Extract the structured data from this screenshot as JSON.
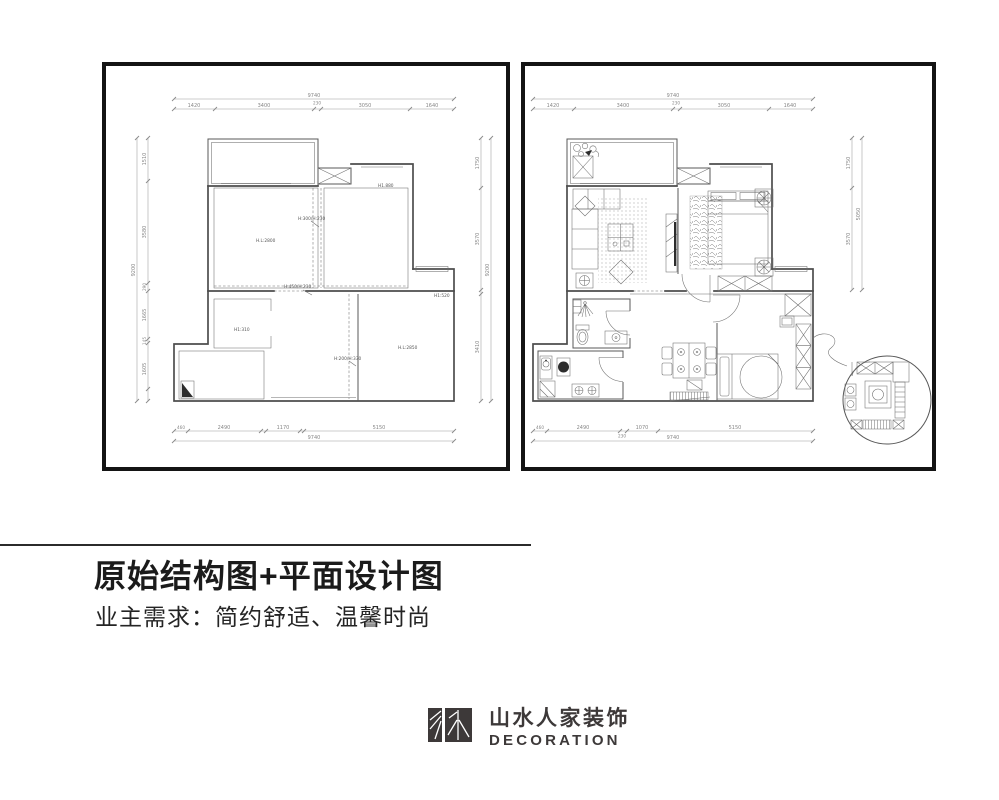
{
  "title_block": {
    "title": "原始结构图+平面设计图",
    "subtitle": "业主需求：简约舒适、温馨时尚"
  },
  "logo": {
    "cn": "山水人家装饰",
    "en": "DECORATION"
  },
  "colors": {
    "panel_border": "#141414",
    "line": "#4d4d4d",
    "dim_text": "#878787",
    "logo": "#3d3939"
  },
  "panels": {
    "left": {
      "dims_top": {
        "overall": "9740",
        "segments": [
          "1420",
          "3400",
          "230",
          "3050",
          "1640"
        ]
      },
      "dims_left": {
        "overall": "9200",
        "segments": [
          "1510",
          "3580",
          "290",
          "1665",
          "145",
          "1605"
        ]
      },
      "dims_right": {
        "overall": "9200",
        "segments": [
          "1750",
          "3570",
          "3410"
        ]
      },
      "dims_bottom": {
        "overall": "9740",
        "segments": [
          "460",
          "2490",
          "1170",
          "5150"
        ]
      },
      "labels": {
        "h1880": "H1.880",
        "hl2800": "H.L:2800",
        "beam1": "H:300/H:230",
        "beam2": "H:450/H:230",
        "h1520": "H1:520",
        "h1310": "H1:310",
        "beam3": "H:200/H:330",
        "hl2850": "H.L:2850"
      }
    },
    "right": {
      "dims_top": {
        "overall": "9740",
        "segments": [
          "1420",
          "3400",
          "230",
          "3050",
          "1640"
        ]
      },
      "dims_right": {
        "overall": "5050",
        "segments": [
          "1750",
          "3570"
        ]
      },
      "dims_bottom": {
        "overall": "9740",
        "segments": [
          "460",
          "2490",
          "230",
          "1070",
          "5150"
        ]
      }
    }
  }
}
